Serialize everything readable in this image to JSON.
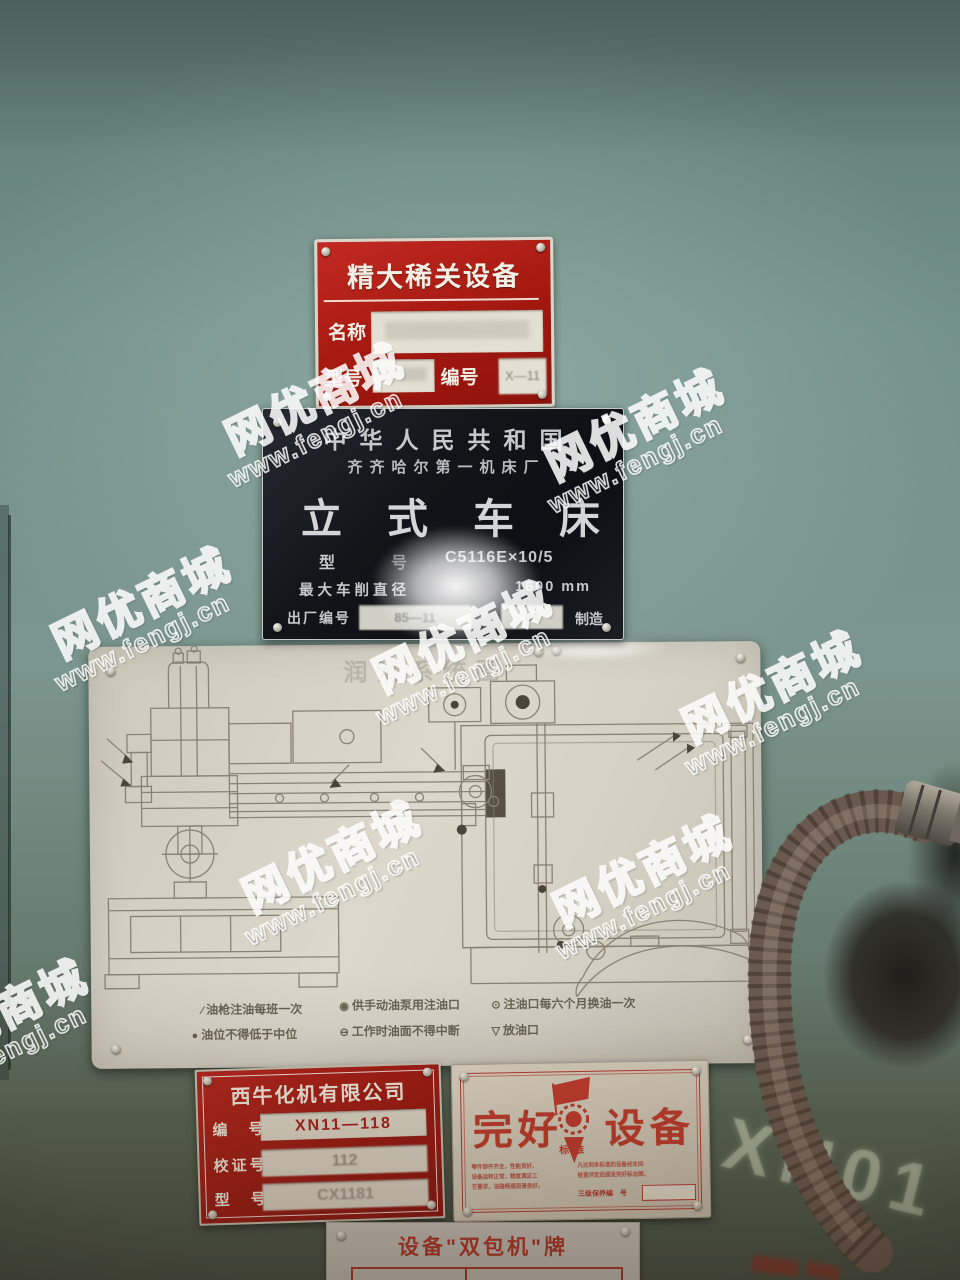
{
  "watermark": {
    "brand": "网优商城",
    "site": "www.fengj.cn"
  },
  "wall": {
    "painted_mark": "XN01"
  },
  "critical_plate": {
    "title": "精大稀关设备",
    "name_label": "名称",
    "name_value": "",
    "model_label": "型号",
    "model_value": "",
    "serial_label": "编号",
    "serial_value": "X—11"
  },
  "nameplate": {
    "country": "中华人民共和国",
    "factory": "齐齐哈尔第一机床厂",
    "product": "立式车床",
    "model_label": "型",
    "model_label2": "号",
    "model_value": "C5116E×10/5",
    "diameter_label": "最大车削直径",
    "diameter_value": "1600 mm",
    "serial_label": "出厂编号",
    "serial_value1": "85—11",
    "serial_value2": "84",
    "made_label": "制造"
  },
  "lubrication_plate": {
    "title": "润滑系统图",
    "legend": [
      {
        "icon": "oil-gun-icon",
        "glyph": "∕",
        "text": "油枪注油每班一次"
      },
      {
        "icon": "hand-pump-port-icon",
        "glyph": "◉",
        "text": "供手动油泵用注油口"
      },
      {
        "icon": "oil-fill-port-icon",
        "glyph": "⊙",
        "text": "注油口每六个月换油一次"
      },
      {
        "icon": "oil-level-icon",
        "glyph": "●",
        "text": "油位不得低于中位"
      },
      {
        "icon": "working-level-icon",
        "glyph": "⊖",
        "text": "工作时油面不得中断"
      },
      {
        "icon": "drain-port-icon",
        "glyph": "▽",
        "text": "放油口"
      }
    ]
  },
  "company_plate": {
    "title": "西牛化机有限公司",
    "rows": [
      {
        "label": "编　号",
        "value": "XN11—118"
      },
      {
        "label": "校证号",
        "value": "112"
      },
      {
        "label": "型　号",
        "value": "CX1181"
      }
    ]
  },
  "good_equipment_plate": {
    "title_left": "完好",
    "title_right": "设备",
    "stamp_caption": "标准",
    "criteria_left": [
      "零件部件齐全，性能良好，",
      "设备运转正常，精度满足工",
      "艺要求，油路畅通润滑良好。"
    ],
    "criteria_right": [
      "凡达到本标准的设备经车间",
      "检查评定后颁发完好标志牌。"
    ],
    "serial_label": "三级保养编　号"
  },
  "contract_plate": {
    "title": "设备\"双包机\"牌",
    "cells": [
      "专责人",
      "机电修理工"
    ]
  }
}
